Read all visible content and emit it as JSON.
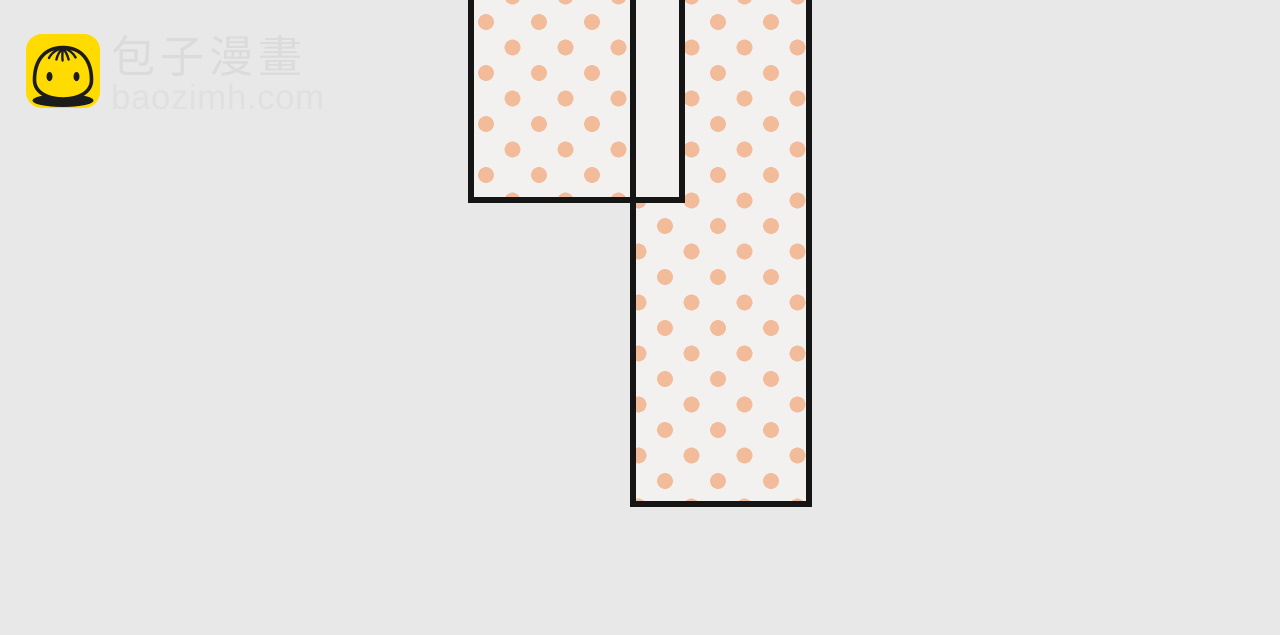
{
  "brand": {
    "name": "包子漫畫",
    "domain": "baozimh.com",
    "icon": "baozi-bun-icon"
  },
  "colors": {
    "page_bg": "#e9e8e8",
    "panel_fill": "#f3f1ef",
    "gutter_fill": "#f2f0ee",
    "panel_border": "#151515",
    "dot": "#f2bb9a",
    "logo_bg": "#ffdb00",
    "logo_line": "#1c1c1c",
    "brand_text": "#dcdbdb",
    "domain_text": "#e1e0e0"
  },
  "comic": {
    "panels": [
      {
        "id": "left-panel",
        "pattern": "polka-dot"
      },
      {
        "id": "gutter-panel",
        "pattern": "plain"
      },
      {
        "id": "tall-panel",
        "pattern": "polka-dot"
      }
    ]
  }
}
